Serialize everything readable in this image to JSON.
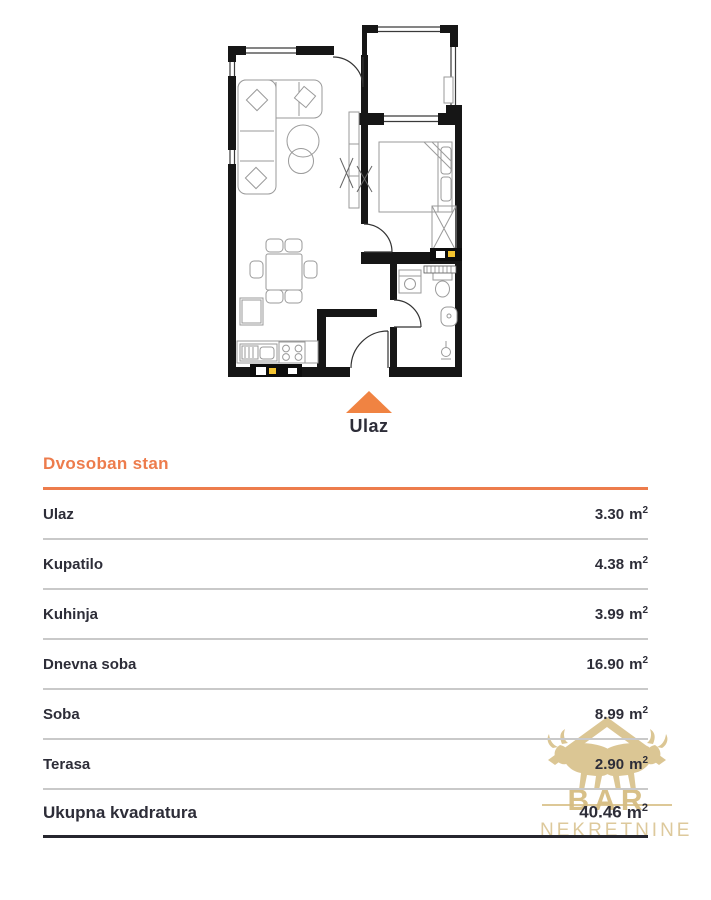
{
  "plan": {
    "entrance_label": "Ulaz"
  },
  "colors": {
    "accent": "#ed7c4c",
    "arrow": "#f08342",
    "gold": "#d9c28c",
    "text": "#2d2d38"
  },
  "table": {
    "title": "Dvosoban stan",
    "unit": {
      "symbol": "m",
      "exp": "2"
    },
    "rows": [
      {
        "name": "Ulaz",
        "area": "3.30"
      },
      {
        "name": "Kupatilo",
        "area": "4.38"
      },
      {
        "name": "Kuhinja",
        "area": "3.99"
      },
      {
        "name": "Dnevna soba",
        "area": "16.90"
      },
      {
        "name": "Soba",
        "area": "8.99"
      },
      {
        "name": "Terasa",
        "area": "2.90"
      }
    ],
    "total": {
      "name": "Ukupna kvadratura",
      "area": "40.46"
    }
  },
  "watermark": {
    "line1": "BAR",
    "line2": "NEKRETNINE"
  }
}
